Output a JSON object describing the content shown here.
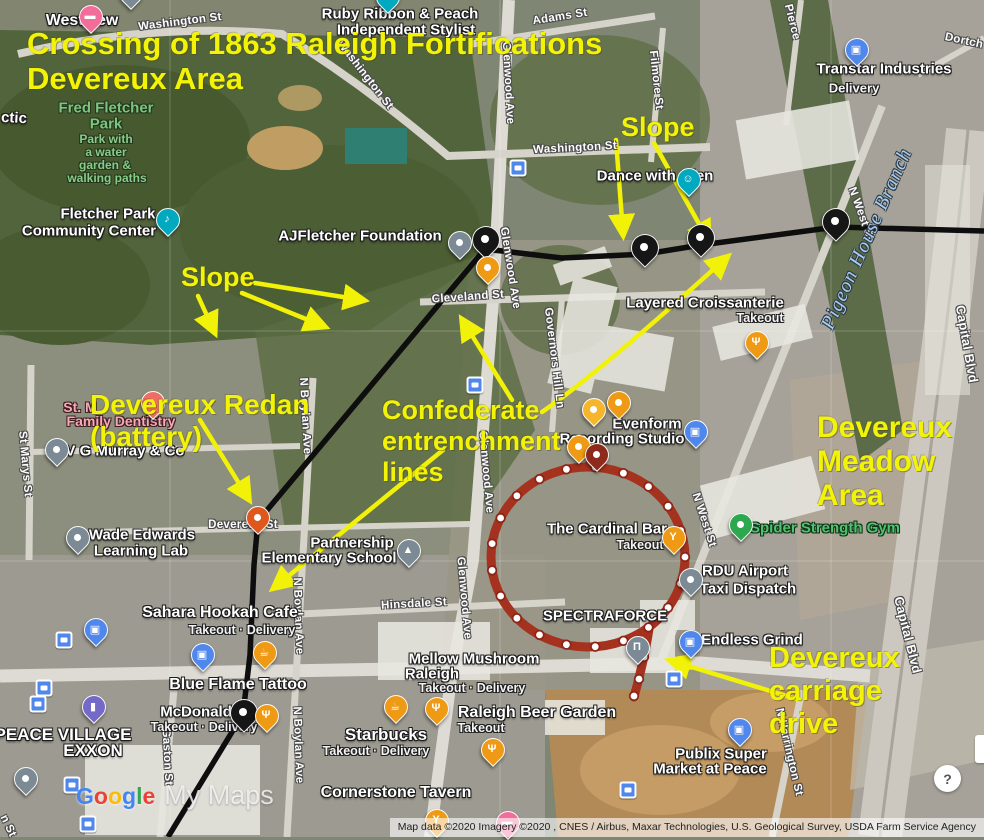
{
  "colors": {
    "annotation_yellow": "#f3f307",
    "fortification_line": "#0e0e0e",
    "carriage_ring_red": "#a5321f",
    "google_blue": "#4285F4",
    "google_red": "#EA4335",
    "google_yellow": "#FBBC05",
    "google_green": "#34A853"
  },
  "title": {
    "lines": [
      "Crossing of 1863 Raleigh Fortifications",
      "Devereux Area"
    ]
  },
  "annotations": {
    "labels": [
      {
        "id": "slope-right",
        "lines": [
          "Slope"
        ],
        "x": 621,
        "y": 112,
        "size": 27
      },
      {
        "id": "slope-left",
        "lines": [
          "Slope"
        ],
        "x": 181,
        "y": 262,
        "size": 27
      },
      {
        "id": "devereux-redan",
        "lines": [
          "Devereux Redan",
          "(battery)"
        ],
        "x": 90,
        "y": 389,
        "size": 28
      },
      {
        "id": "confederate-entrenchment-lines",
        "lines": [
          "Confederate",
          "entrenchment",
          "lines"
        ],
        "x": 382,
        "y": 395,
        "size": 27
      },
      {
        "id": "devereux-meadow-area",
        "lines": [
          "Devereux",
          "Meadow",
          "Area"
        ],
        "x": 817,
        "y": 411,
        "size": 30
      },
      {
        "id": "devereux-carriage-drive",
        "lines": [
          "Devereux",
          "carriage",
          "drive"
        ],
        "x": 769,
        "y": 642,
        "size": 29
      }
    ],
    "arrows": [
      {
        "f": [
          616,
          140
        ],
        "t": [
          623,
          233
        ]
      },
      {
        "f": [
          654,
          143
        ],
        "t": [
          708,
          240
        ]
      },
      {
        "f": [
          255,
          283
        ],
        "t": [
          362,
          300
        ]
      },
      {
        "f": [
          242,
          293
        ],
        "t": [
          323,
          326
        ]
      },
      {
        "f": [
          198,
          296
        ],
        "t": [
          214,
          331
        ]
      },
      {
        "f": [
          200,
          420
        ],
        "t": [
          248,
          498
        ]
      },
      {
        "f": [
          512,
          400
        ],
        "t": [
          463,
          321
        ]
      },
      {
        "f": [
          542,
          412
        ],
        "c": [
          600,
          372
        ],
        "t": [
          726,
          258
        ]
      },
      {
        "f": [
          443,
          450
        ],
        "t": [
          275,
          587
        ]
      },
      {
        "f": [
          800,
          700
        ],
        "t": [
          672,
          661
        ]
      }
    ]
  },
  "map": {
    "labels": [
      {
        "t": "Washington St",
        "x": 180,
        "y": 22,
        "r": -7,
        "c": "street"
      },
      {
        "t": "Washington St",
        "x": 365,
        "y": 75,
        "r": 52,
        "c": "street"
      },
      {
        "t": "Washington St",
        "x": 575,
        "y": 148,
        "r": -3,
        "c": "street"
      },
      {
        "t": "Adams St",
        "x": 560,
        "y": 17,
        "r": -9,
        "c": "street"
      },
      {
        "t": "Pierce",
        "x": 792,
        "y": 22,
        "r": 76,
        "c": "street"
      },
      {
        "t": "Dortch",
        "x": 964,
        "y": 41,
        "r": 12,
        "c": "street"
      },
      {
        "t": "Filmore St",
        "x": 656,
        "y": 80,
        "r": 84,
        "c": "street"
      },
      {
        "t": "Glenwood Ave",
        "x": 508,
        "y": 83,
        "r": 87,
        "c": "street"
      },
      {
        "t": "Glenwood Ave",
        "x": 510,
        "y": 268,
        "r": 81,
        "c": "street"
      },
      {
        "t": "Glenwood Ave",
        "x": 486,
        "y": 472,
        "r": 85,
        "c": "street"
      },
      {
        "t": "Glenwood Ave",
        "x": 464,
        "y": 598,
        "r": 85,
        "c": "street"
      },
      {
        "t": "Cleveland St",
        "x": 468,
        "y": 297,
        "r": -4,
        "c": "street"
      },
      {
        "t": "Governors Hill Ln",
        "x": 554,
        "y": 358,
        "r": 83,
        "c": "street"
      },
      {
        "t": "N West St",
        "x": 861,
        "y": 214,
        "r": 70,
        "c": "street"
      },
      {
        "t": "N West St",
        "x": 704,
        "y": 520,
        "r": 72,
        "c": "street"
      },
      {
        "t": "N Boylan Ave",
        "x": 305,
        "y": 416,
        "r": 87,
        "c": "street"
      },
      {
        "t": "N Boylan Ave",
        "x": 298,
        "y": 616,
        "r": 88,
        "c": "street"
      },
      {
        "t": "N Boylan Ave",
        "x": 298,
        "y": 745,
        "r": 88,
        "c": "street"
      },
      {
        "t": "Hinsdale St",
        "x": 414,
        "y": 604,
        "r": -3,
        "c": "street"
      },
      {
        "t": "St Marys St",
        "x": 25,
        "y": 464,
        "r": 85,
        "c": "street"
      },
      {
        "t": "Gaston St",
        "x": 167,
        "y": 757,
        "r": 87,
        "c": "street"
      },
      {
        "t": "N Harrington St",
        "x": 789,
        "y": 752,
        "r": 77,
        "c": "street"
      },
      {
        "t": "Capital Blvd",
        "x": 967,
        "y": 344,
        "r": 80,
        "s": 13,
        "c": "street"
      },
      {
        "t": "Capital Blvd",
        "x": 908,
        "y": 635,
        "r": 76,
        "s": 13,
        "c": "street"
      },
      {
        "t": "Devereux St",
        "x": 243,
        "y": 525,
        "c": "street"
      },
      {
        "t": "n St",
        "x": 8,
        "y": 826,
        "r": 65,
        "c": "street"
      },
      {
        "t": "ctic",
        "x": 14,
        "y": 118,
        "r": 3,
        "c": "poi"
      },
      {
        "t": "Pigeon House Branch",
        "x": 867,
        "y": 239,
        "r": -66,
        "c": "water"
      },
      {
        "t": "Westview",
        "x": 82,
        "y": 21,
        "s": 16,
        "c": "poi"
      },
      {
        "t": "Ruby Ribbon & Peach",
        "x": 400,
        "y": 14,
        "c": "poi"
      },
      {
        "t": "Independent Stylist",
        "x": 406,
        "y": 30,
        "c": "poi"
      },
      {
        "t": "Transtar Industries",
        "x": 884,
        "y": 69,
        "c": "poi"
      },
      {
        "t": "Delivery",
        "x": 854,
        "y": 88,
        "s": 13,
        "c": "sub"
      },
      {
        "t": "Fred Fletcher",
        "x": 106,
        "y": 108,
        "c": "park"
      },
      {
        "t": "Park",
        "x": 106,
        "y": 124,
        "c": "park"
      },
      {
        "t": "Park with",
        "x": 106,
        "y": 139,
        "c": "parksub"
      },
      {
        "t": "a water",
        "x": 106,
        "y": 152,
        "c": "parksub"
      },
      {
        "t": "garden &",
        "x": 105,
        "y": 165,
        "c": "parksub"
      },
      {
        "t": "walking paths",
        "x": 107,
        "y": 178,
        "c": "parksub"
      },
      {
        "t": "Fletcher Park",
        "x": 108,
        "y": 214,
        "c": "poi"
      },
      {
        "t": "Community Center",
        "x": 89,
        "y": 231,
        "c": "poi"
      },
      {
        "t": "AJFletcher Foundation",
        "x": 360,
        "y": 236,
        "c": "poi"
      },
      {
        "t": "Dance with Glen",
        "x": 655,
        "y": 176,
        "c": "poi"
      },
      {
        "t": "Layered Croissanterie",
        "x": 705,
        "y": 303,
        "c": "poi"
      },
      {
        "t": "Takeout",
        "x": 760,
        "y": 318,
        "c": "sub"
      },
      {
        "t": "Evenform",
        "x": 647,
        "y": 424,
        "c": "poi"
      },
      {
        "t": "Recording Studio",
        "x": 622,
        "y": 439,
        "c": "poi"
      },
      {
        "t": "The Cardinal Bar",
        "x": 607,
        "y": 529,
        "c": "poi"
      },
      {
        "t": "Takeout",
        "x": 640,
        "y": 545,
        "c": "sub"
      },
      {
        "t": "Spider Strength Gym",
        "x": 825,
        "y": 528,
        "c": "green"
      },
      {
        "t": "RDU Airport",
        "x": 745,
        "y": 571,
        "c": "poi"
      },
      {
        "t": "Taxi Dispatch",
        "x": 748,
        "y": 589,
        "c": "poi"
      },
      {
        "t": "Endless Grind",
        "x": 752,
        "y": 640,
        "c": "poi"
      },
      {
        "t": "SPECTRAFORCE",
        "x": 605,
        "y": 616,
        "c": "poi"
      },
      {
        "t": "Wade Edwards",
        "x": 142,
        "y": 535,
        "c": "poi"
      },
      {
        "t": "Learning Lab",
        "x": 141,
        "y": 551,
        "c": "poi"
      },
      {
        "t": "V G Murray & Co",
        "x": 125,
        "y": 451,
        "c": "poi"
      },
      {
        "t": "St. M",
        "x": 80,
        "y": 407,
        "c": "pink"
      },
      {
        "t": "Family Dentistry",
        "x": 121,
        "y": 421,
        "c": "pink"
      },
      {
        "t": "Partnership",
        "x": 352,
        "y": 543,
        "c": "poi"
      },
      {
        "t": "Elementary School",
        "x": 329,
        "y": 558,
        "c": "poi"
      },
      {
        "t": "Sahara Hookah Cafe",
        "x": 220,
        "y": 613,
        "s": 16,
        "c": "poi"
      },
      {
        "t": "Takeout · Delivery",
        "x": 242,
        "y": 630,
        "c": "sub"
      },
      {
        "t": "Blue Flame Tattoo",
        "x": 238,
        "y": 685,
        "s": 16,
        "c": "poi"
      },
      {
        "t": "McDonald's",
        "x": 202,
        "y": 712,
        "c": "poi"
      },
      {
        "t": "Takeout · Delivery",
        "x": 204,
        "y": 727,
        "c": "sub"
      },
      {
        "t": "PEACE VILLAGE",
        "x": 63,
        "y": 735,
        "s": 17,
        "c": "poi"
      },
      {
        "t": "EXXON",
        "x": 93,
        "y": 751,
        "s": 17,
        "c": "poi"
      },
      {
        "t": "Mellow Mushroom",
        "x": 474,
        "y": 659,
        "c": "poi"
      },
      {
        "t": "Raleigh",
        "x": 432,
        "y": 674,
        "c": "poi"
      },
      {
        "t": "Takeout · Delivery",
        "x": 472,
        "y": 688,
        "c": "sub"
      },
      {
        "t": "Starbucks",
        "x": 386,
        "y": 735,
        "s": 17,
        "c": "poi"
      },
      {
        "t": "Takeout · Delivery",
        "x": 376,
        "y": 751,
        "c": "sub"
      },
      {
        "t": "Raleigh Beer Garden",
        "x": 537,
        "y": 713,
        "s": 16,
        "c": "poi"
      },
      {
        "t": "Takeout",
        "x": 481,
        "y": 728,
        "c": "sub"
      },
      {
        "t": "Cornerstone Tavern",
        "x": 396,
        "y": 793,
        "s": 16,
        "c": "poi"
      },
      {
        "t": "Publix Super",
        "x": 721,
        "y": 754,
        "c": "poi"
      },
      {
        "t": "Market at Peace",
        "x": 710,
        "y": 769,
        "c": "poi"
      }
    ],
    "pin_colors": {
      "black": "#161616",
      "gray": "#7b8a94",
      "orange": "#ef9a14",
      "lightorange": "#f6b62c",
      "darkred": "#8e2a1c",
      "redorange": "#e0571d",
      "blue": "#5087ec",
      "teal": "#00a8c0",
      "pink": "#f26d9a",
      "coral": "#ee6e63",
      "green": "#2ea84f",
      "purple": "#7569c8"
    },
    "pins": [
      {
        "x": 485,
        "y": 258,
        "c": "black",
        "g": "dot",
        "lg": 1
      },
      {
        "x": 644,
        "y": 266,
        "c": "black",
        "g": "dot",
        "lg": 1
      },
      {
        "x": 700,
        "y": 256,
        "c": "black",
        "g": "dot",
        "lg": 1
      },
      {
        "x": 835,
        "y": 240,
        "c": "black",
        "g": "dot",
        "lg": 1
      },
      {
        "x": 243,
        "y": 731,
        "c": "black",
        "g": "dot",
        "lg": 1
      },
      {
        "x": 459,
        "y": 258,
        "c": "gray",
        "g": "dot"
      },
      {
        "x": 56,
        "y": 465,
        "c": "gray",
        "g": "dot"
      },
      {
        "x": 77,
        "y": 553,
        "c": "gray",
        "g": "dot"
      },
      {
        "x": 690,
        "y": 595,
        "c": "gray",
        "g": "dot"
      },
      {
        "x": 25,
        "y": 794,
        "c": "gray",
        "g": "dot"
      },
      {
        "x": 130,
        "y": 8,
        "c": "gray",
        "g": "dot"
      },
      {
        "x": 408,
        "y": 566,
        "c": "gray",
        "g": "graduation"
      },
      {
        "x": 637,
        "y": 663,
        "c": "gray",
        "g": "bank"
      },
      {
        "x": 487,
        "y": 283,
        "c": "orange",
        "g": "dot"
      },
      {
        "x": 756,
        "y": 358,
        "c": "orange",
        "g": "restaurant"
      },
      {
        "x": 593,
        "y": 425,
        "c": "lightorange",
        "g": "dot"
      },
      {
        "x": 618,
        "y": 418,
        "c": "orange",
        "g": "dot"
      },
      {
        "x": 578,
        "y": 462,
        "c": "orange",
        "g": "dot"
      },
      {
        "x": 673,
        "y": 553,
        "c": "orange",
        "g": "cocktail"
      },
      {
        "x": 264,
        "y": 668,
        "c": "orange",
        "g": "coffee"
      },
      {
        "x": 266,
        "y": 731,
        "c": "orange",
        "g": "restaurant"
      },
      {
        "x": 395,
        "y": 722,
        "c": "orange",
        "g": "coffee"
      },
      {
        "x": 436,
        "y": 724,
        "c": "orange",
        "g": "restaurant"
      },
      {
        "x": 492,
        "y": 765,
        "c": "orange",
        "g": "restaurant"
      },
      {
        "x": 436,
        "y": 836,
        "c": "orange",
        "g": "cocktail"
      },
      {
        "x": 596,
        "y": 470,
        "c": "darkred",
        "g": "dot"
      },
      {
        "x": 257,
        "y": 533,
        "c": "redorange",
        "g": "dot"
      },
      {
        "x": 856,
        "y": 65,
        "c": "blue",
        "g": "bag"
      },
      {
        "x": 695,
        "y": 447,
        "c": "blue",
        "g": "bag"
      },
      {
        "x": 690,
        "y": 657,
        "c": "blue",
        "g": "bag"
      },
      {
        "x": 95,
        "y": 645,
        "c": "blue",
        "g": "bag"
      },
      {
        "x": 202,
        "y": 670,
        "c": "blue",
        "g": "bag"
      },
      {
        "x": 739,
        "y": 745,
        "c": "blue",
        "g": "cart"
      },
      {
        "x": 167,
        "y": 235,
        "c": "teal",
        "g": "music"
      },
      {
        "x": 688,
        "y": 195,
        "c": "teal",
        "g": "dance"
      },
      {
        "x": 387,
        "y": 12,
        "c": "teal",
        "g": "dot"
      },
      {
        "x": 90,
        "y": 32,
        "c": "pink",
        "g": "bed"
      },
      {
        "x": 507,
        "y": 838,
        "c": "pink",
        "g": "bed"
      },
      {
        "x": 152,
        "y": 418,
        "c": "coral",
        "g": "house"
      },
      {
        "x": 740,
        "y": 540,
        "c": "green",
        "g": "dot"
      },
      {
        "x": 93,
        "y": 722,
        "c": "purple",
        "g": "gas"
      }
    ],
    "bus_stops": [
      [
        518,
        168
      ],
      [
        475,
        385
      ],
      [
        64,
        640
      ],
      [
        44,
        688
      ],
      [
        38,
        704
      ],
      [
        72,
        785
      ],
      [
        88,
        824
      ],
      [
        674,
        679
      ],
      [
        628,
        790
      ]
    ]
  },
  "watermark": {
    "google_letters": [
      [
        "G",
        "#4285F4"
      ],
      [
        "o",
        "#EA4335"
      ],
      [
        "o",
        "#FBBC05"
      ],
      [
        "g",
        "#4285F4"
      ],
      [
        "l",
        "#34A853"
      ],
      [
        "e",
        "#EA4335"
      ]
    ],
    "my_maps": "My Maps"
  },
  "attribution": "Map data ©2020 Imagery ©2020 , CNES / Airbus, Maxar Technologies, U.S. Geological Survey, USDA Farm Service Agency",
  "help_button_label": "?"
}
